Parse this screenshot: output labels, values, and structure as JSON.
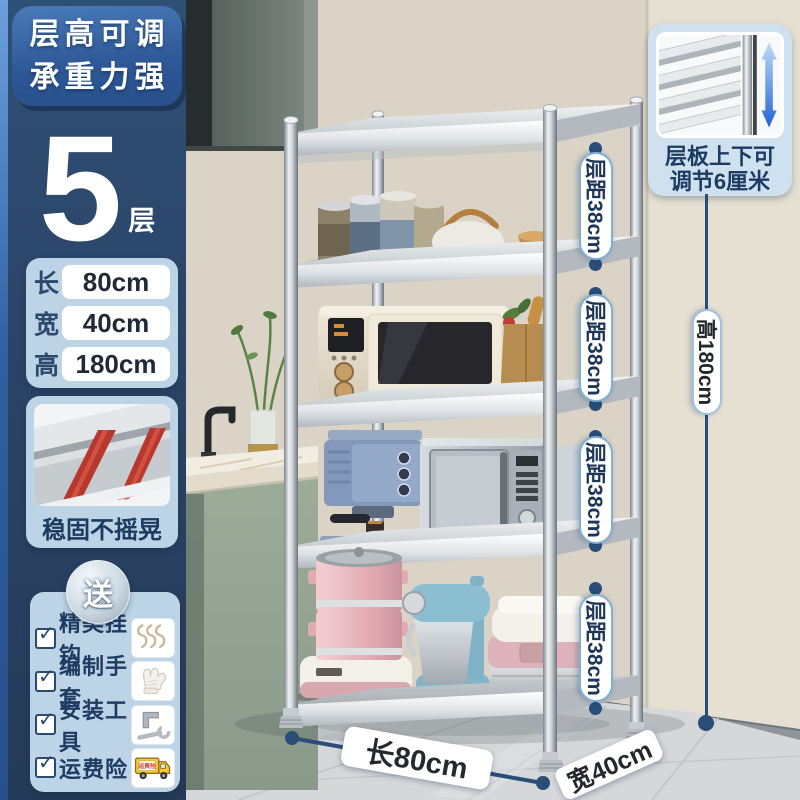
{
  "badge": {
    "line1": "层高可调",
    "line2": "承重力强"
  },
  "layers": {
    "number": "5",
    "unit": "层"
  },
  "dimensions": {
    "rows": [
      {
        "label": "长",
        "value": "80cm"
      },
      {
        "label": "宽",
        "value": "40cm"
      },
      {
        "label": "高",
        "value": "180cm"
      }
    ]
  },
  "stability": {
    "caption": "稳固不摇晃"
  },
  "gifts": {
    "badge": "送",
    "check": "✓",
    "items": [
      {
        "label": "精美挂钩",
        "icon": "s-hooks-icon"
      },
      {
        "label": "编制手套",
        "icon": "gloves-icon"
      },
      {
        "label": "安装工具",
        "icon": "tools-icon"
      },
      {
        "label": "运费险",
        "icon": "truck-icon"
      }
    ],
    "truck_label": "运费险"
  },
  "adjust_inset": {
    "line1": "层板上下可",
    "line2": "调节6厘米"
  },
  "annotations": {
    "gaps": [
      "层距38cm",
      "层距38cm",
      "层距38cm",
      "层距38cm"
    ],
    "height": "高180cm",
    "length": "长80cm",
    "width": "宽40cm"
  },
  "colors": {
    "badge_blue": "#35639f",
    "panel_navy": "#2d4a6d",
    "card_blue": "#bdd3e6",
    "annotation_navy": "#2b4e79",
    "accent_red": "#b8382e",
    "arrow_blue": "#1e63d6"
  }
}
